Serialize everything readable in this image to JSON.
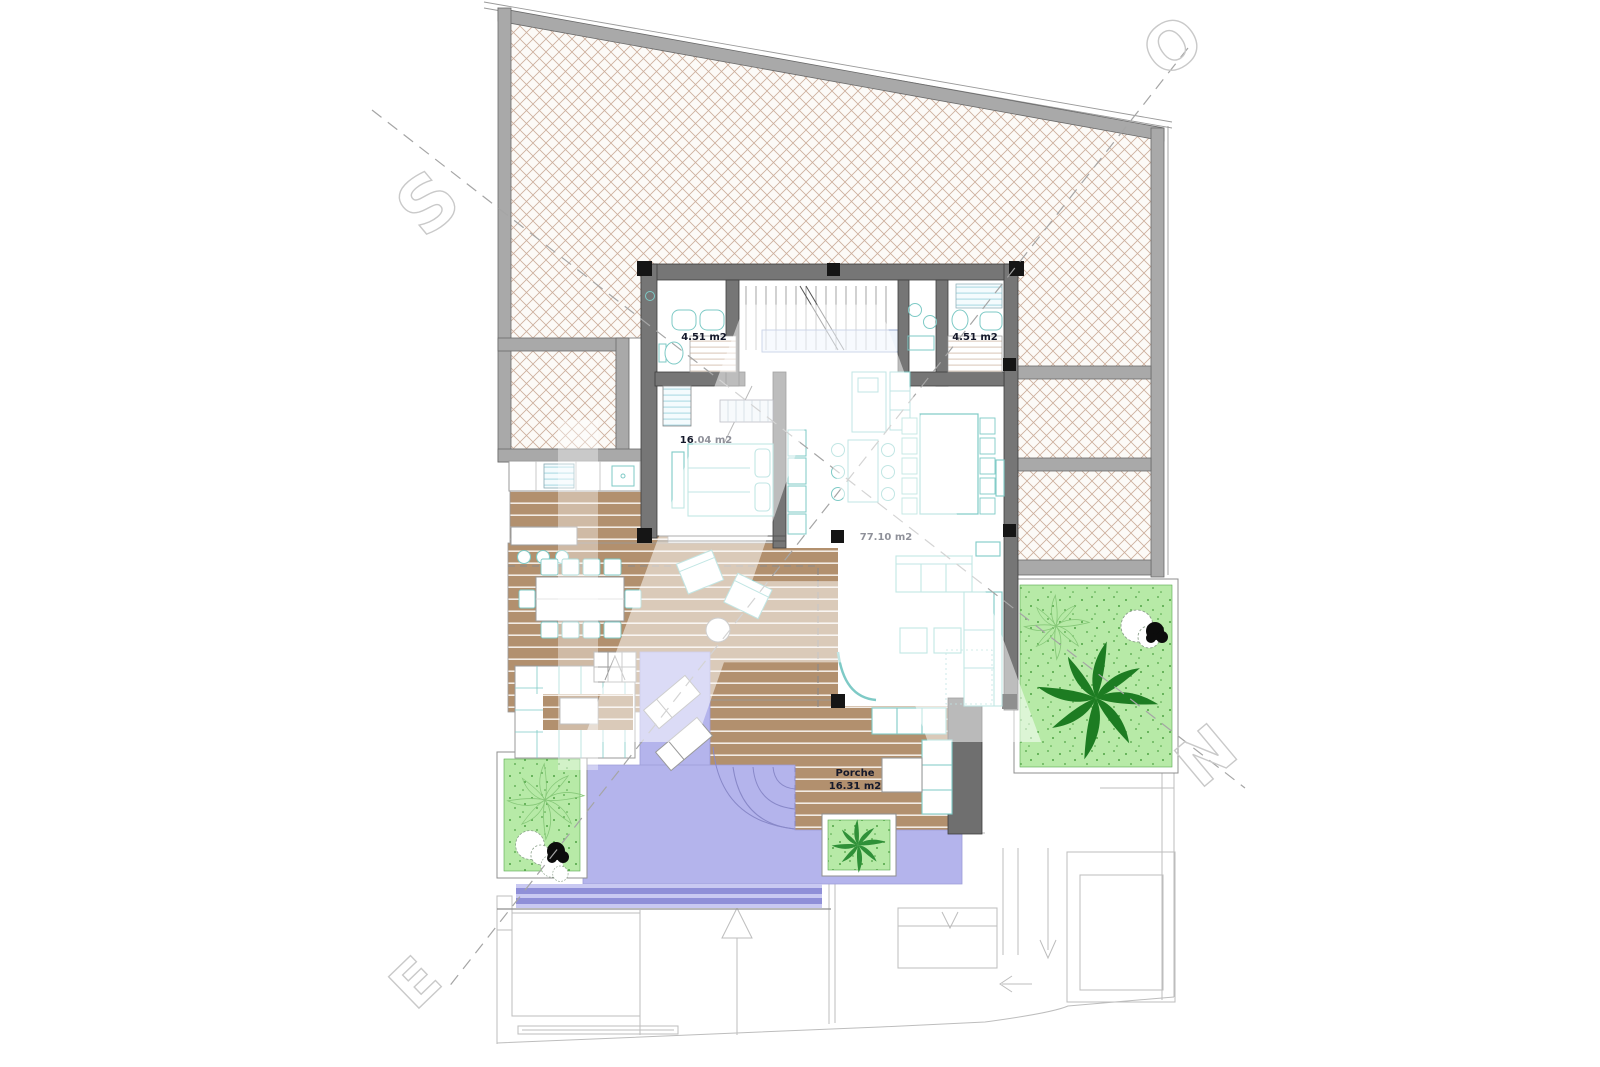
{
  "plan": {
    "labels": {
      "bath_left": "4.51 m2",
      "bath_right": "4.51 m2",
      "bedroom": "16.04 m2",
      "living": "77.10 m2",
      "porch_name": "Porche",
      "porch_area": "16.31 m2"
    },
    "watermark": {
      "center": "A",
      "top_left": "S",
      "top_right": "O",
      "right": "N",
      "bottom_left": "E"
    },
    "colors": {
      "deck_wood": "#b2906e",
      "pool_water": "#b4b4ec",
      "pool_edge_stripe": "#8f8fd8",
      "grass": "#b7eaa7",
      "palm_dark": "#1d7c22",
      "hatch_line": "#ccae9c",
      "building_wall": "#767676",
      "site_wall": "#a9a9a9",
      "furniture_outline": "#7ecac6",
      "label_text": "#14182a",
      "faint_line": "#bdbdbd"
    }
  }
}
